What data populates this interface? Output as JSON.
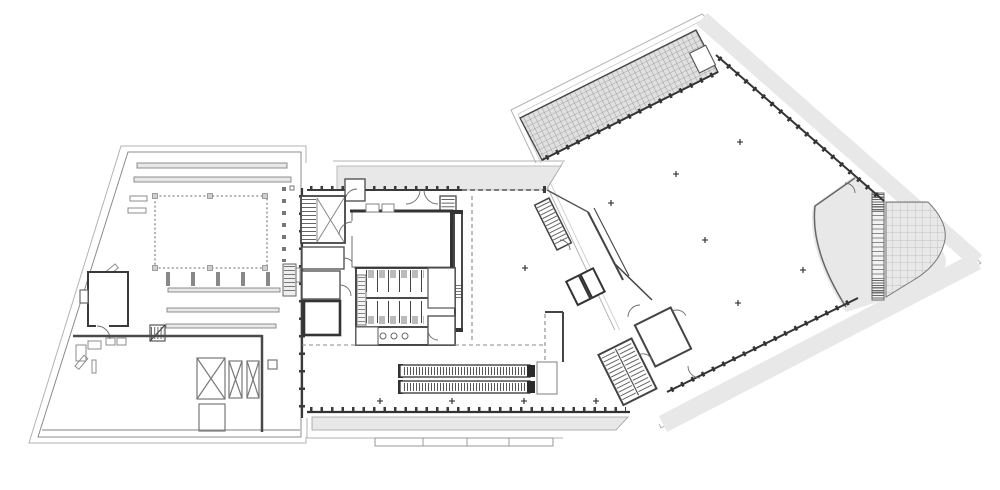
{
  "drawing": {
    "kind": "architectural-floor-plan",
    "text_labels": [],
    "wings": {
      "west_wing": {
        "name": "west-wing-roof-deck",
        "features": [
          "roof-light-bars",
          "dashed-courtyard-opening",
          "plant-room",
          "mini-stair",
          "skylight-x-boxes",
          "service-hatch-squares",
          "edge-tick-squares"
        ]
      },
      "center_wing": {
        "name": "center-wing-core",
        "features": [
          "top-terrace-band",
          "mullioned-facade",
          "stair-block",
          "toilet-block",
          "big-room",
          "shaft-wall",
          "escalator-pair",
          "column-markers",
          "bottom-canopy-band"
        ]
      },
      "east_wing": {
        "name": "east-wing-hall",
        "rotation_deg": -26.5,
        "features": [
          "crosshatch-skylight-band",
          "ne-terrace-band",
          "se-terrace-band",
          "gridded-deck-triangle",
          "louvre-strip",
          "curved-wall",
          "column-markers"
        ]
      },
      "junction": {
        "name": "junction-core",
        "features": [
          "switchback-stair",
          "straight-stair",
          "elevator-pair",
          "corridor-walls",
          "door-swings"
        ]
      }
    },
    "symbols": {
      "column_marker_glyph": "+",
      "escalator_runs": 2,
      "toilet_stalls_per_row": 5,
      "sink_count": 4,
      "skylight_x_boxes": 3
    }
  },
  "colors": {
    "page_bg": "#ffffff",
    "area_fill": "#e8e8e8",
    "area_fill_dark": "#e3e3e3",
    "outline_thin": "#b3b3b3",
    "outline_mid": "#8c8c8c",
    "wall": "#3a3a3a",
    "wall_light": "#6b6b6b",
    "grid_line": "#b5b5b5",
    "fixture": "#9a9a9a",
    "marker": "#222222"
  }
}
